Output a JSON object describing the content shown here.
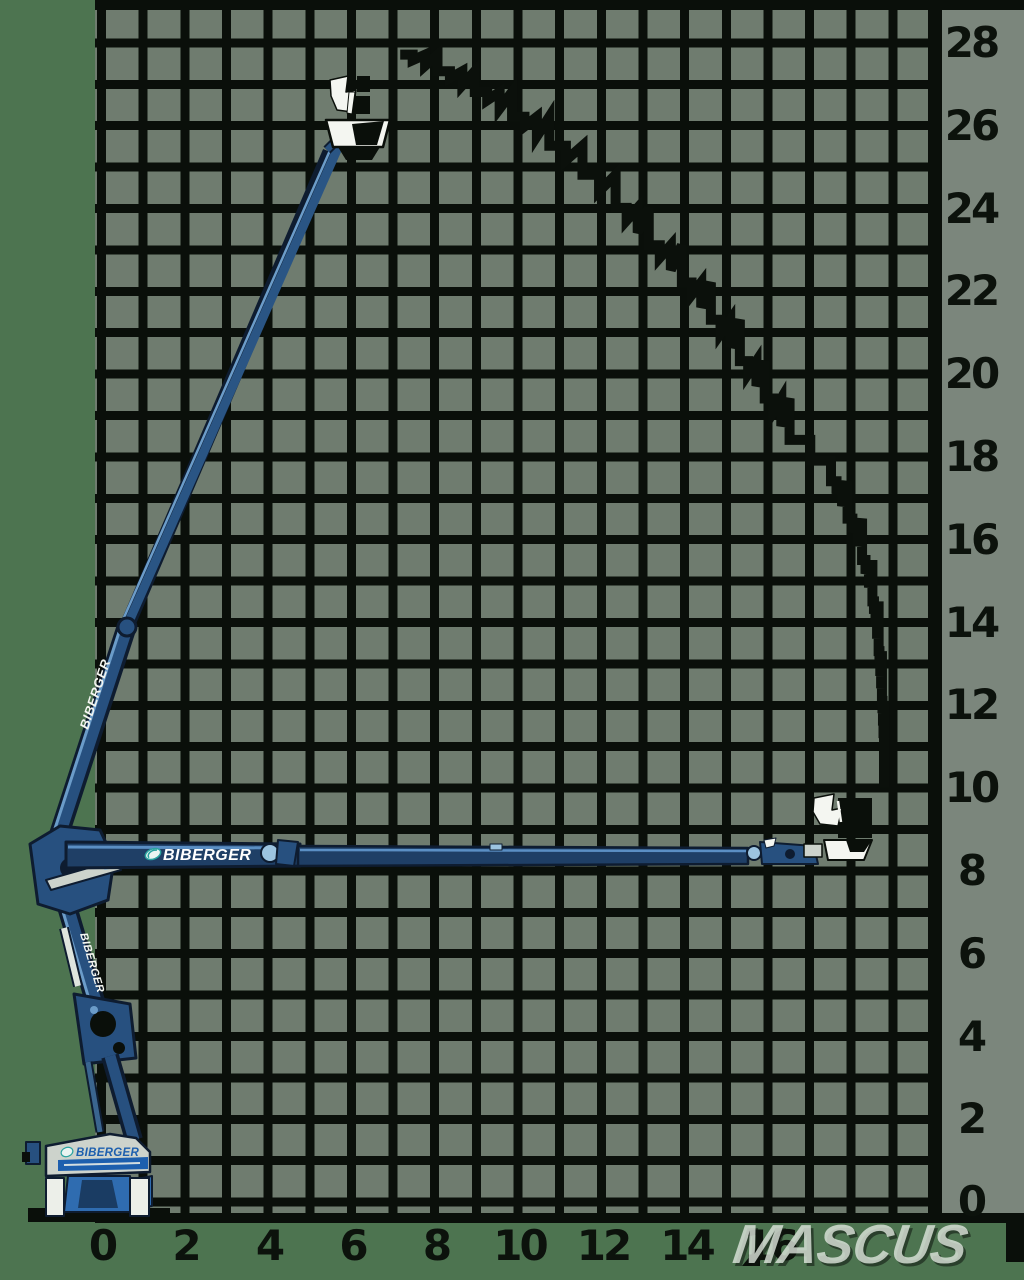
{
  "machine": {
    "brand": "BIBERGER"
  },
  "watermark": {
    "text": "MASCUS"
  },
  "axes": {
    "right": {
      "labels": [
        "28",
        "26",
        "24",
        "22",
        "20",
        "18",
        "16",
        "14",
        "12",
        "10",
        "8",
        "6",
        "4",
        "2",
        "0"
      ]
    },
    "bottom": {
      "labels": [
        "0",
        "2",
        "4",
        "6",
        "8",
        "10",
        "12",
        "14",
        "16"
      ]
    }
  },
  "chart_data": {
    "type": "line",
    "title": "",
    "xlabel": "",
    "ylabel": "",
    "xlim": [
      0,
      20.2
    ],
    "ylim": [
      0,
      29.2
    ],
    "x_ticks": [
      0,
      2,
      4,
      6,
      8,
      10,
      12,
      14,
      16
    ],
    "y_ticks": [
      0,
      2,
      4,
      6,
      8,
      10,
      12,
      14,
      16,
      18,
      20,
      22,
      24,
      26,
      28
    ],
    "grid": true,
    "legend": "none",
    "series": [
      {
        "name": "working-envelope",
        "points": [
          [
            7.2,
            27.7
          ],
          [
            8.1,
            27.3
          ],
          [
            9.0,
            26.8
          ],
          [
            9.9,
            26.2
          ],
          [
            10.8,
            25.5
          ],
          [
            11.6,
            24.8
          ],
          [
            12.4,
            24.0
          ],
          [
            13.2,
            23.1
          ],
          [
            14.0,
            22.2
          ],
          [
            14.7,
            21.3
          ],
          [
            15.4,
            20.3
          ],
          [
            16.0,
            19.4
          ],
          [
            16.6,
            18.4
          ],
          [
            17.1,
            17.9
          ],
          [
            17.6,
            17.4
          ],
          [
            18.0,
            16.5
          ],
          [
            18.35,
            15.5
          ],
          [
            18.6,
            14.5
          ],
          [
            18.75,
            13.3
          ],
          [
            18.83,
            12.1
          ],
          [
            18.88,
            10.9
          ],
          [
            18.88,
            10.0
          ]
        ]
      }
    ],
    "annotations": {
      "max_platform_height_m": 28,
      "max_outreach_m": 19,
      "basket_positions": [
        {
          "x_m": 6.2,
          "y_m": 27.5
        },
        {
          "x_m": 18.2,
          "y_m": 9.5
        }
      ]
    }
  }
}
